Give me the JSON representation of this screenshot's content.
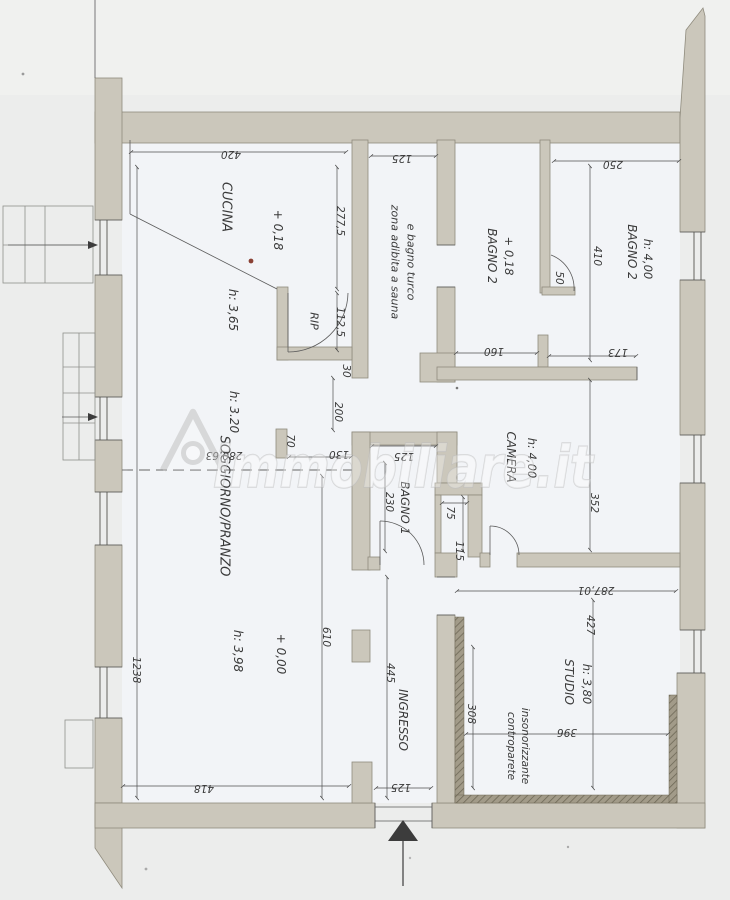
{
  "watermark": {
    "text": "immobiliare.it"
  },
  "rooms": {
    "cucina": {
      "label": "CUCINA",
      "level": "+ 0,18",
      "height": "h: 3,65"
    },
    "rip": {
      "label": "RIP"
    },
    "sauna": {
      "line1": "zona adibita a sauna",
      "line2": "e bagno turco"
    },
    "bagno2_left": {
      "label": "BAGNO 2",
      "level": "+ 0,18"
    },
    "bagno2_right": {
      "label": "BAGNO 2",
      "height": "h: 4,00"
    },
    "soggiorno": {
      "label": "SOGGIORNO/PRANZO",
      "height_upper": "h: 3.20",
      "height_lower": "h: 3,98",
      "level": "+ 0,00"
    },
    "bagno1": {
      "label": "BAGNO 1"
    },
    "camera": {
      "label": "CAMERA",
      "height": "h: 4,00"
    },
    "ingresso": {
      "label": "INGRESSO"
    },
    "studio": {
      "label": "STUDIO",
      "height": "h: 3,80",
      "note_line1": "controparete",
      "note_line2": "insonorizzante"
    }
  },
  "dimensions": {
    "cucina_width": "420",
    "sauna_width": "125",
    "bagno2_width": "250",
    "cucina_depth": "277,5",
    "rip_depth": "112,5",
    "wall_30": "30",
    "bagno2_depth": "410",
    "ledge_50": "50",
    "seg_160": "160",
    "seg_173": "173",
    "passage_200": "200",
    "ceiling_280": "280,63",
    "pillar_70": "70",
    "gap_130": "130",
    "bagno1_width": "125",
    "bagno1_depth": "230",
    "niche_width": "75",
    "niche_depth": "115",
    "camera_depth": "352",
    "camera_width": "287,01",
    "studio_depth": "427",
    "studio_width": "396",
    "studio_inner": "308",
    "soggiorno_lower": "610",
    "left_total": "1238",
    "ingresso_depth": "445",
    "soggiorno_width": "418",
    "entrance_width": "125"
  }
}
